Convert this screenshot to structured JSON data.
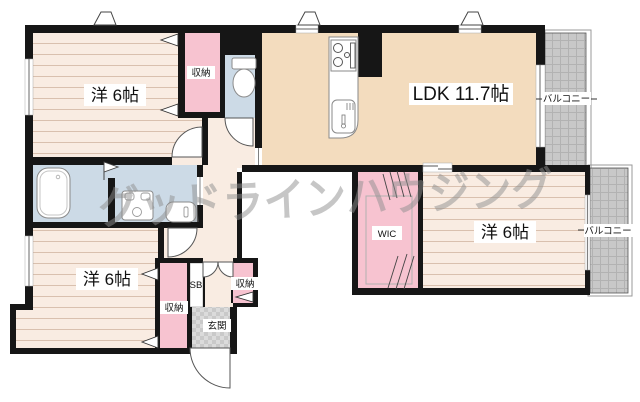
{
  "floorplan": {
    "type": "apartment-floorplan",
    "labels": {
      "bedroom": "洋 6帖",
      "ldk": "LDK 11.7帖",
      "wic": "WIC",
      "storage": "収納",
      "shoe_box": "SB",
      "entrance": "玄関",
      "balcony": "バルコニー",
      "watermark": "グッドラインハウジング"
    },
    "rooms": [
      {
        "name": "bedroom-top-left",
        "label": "洋 6帖",
        "floor": "wood"
      },
      {
        "name": "bedroom-bottom-left",
        "label": "洋 6帖",
        "floor": "wood"
      },
      {
        "name": "bedroom-right",
        "label": "洋 6帖",
        "floor": "wood"
      },
      {
        "name": "ldk",
        "label": "LDK 11.7帖",
        "floor": "plain"
      },
      {
        "name": "wic",
        "label": "WIC",
        "floor": "closet"
      },
      {
        "name": "storage-top",
        "label": "収納"
      },
      {
        "name": "storage-bottom",
        "label": "収納"
      },
      {
        "name": "storage-entrance",
        "label": "収納"
      },
      {
        "name": "shoe-box",
        "label": "SB"
      },
      {
        "name": "entrance",
        "label": "玄関"
      },
      {
        "name": "balcony-top",
        "label": "バルコニー"
      },
      {
        "name": "balcony-bottom",
        "label": "バルコニー"
      }
    ],
    "fixtures": [
      "bathtub",
      "washing-machine",
      "washbasin",
      "toilet",
      "stove",
      "kitchen-sink"
    ],
    "colors": {
      "wall": "#161616",
      "pink": "#f7c3d0",
      "blue": "#ccdae6",
      "beige": "#f3dcbe",
      "cream": "#f9ece2",
      "woodline": "#d9c0ae",
      "balcony": "#c8c8c8",
      "balconyline": "#b2b2b2",
      "genkan1": "#c9c9c9",
      "genkan2": "#dbdbdb",
      "watermark": "#8f8f8f",
      "fixture": "#8a8a8a"
    }
  }
}
